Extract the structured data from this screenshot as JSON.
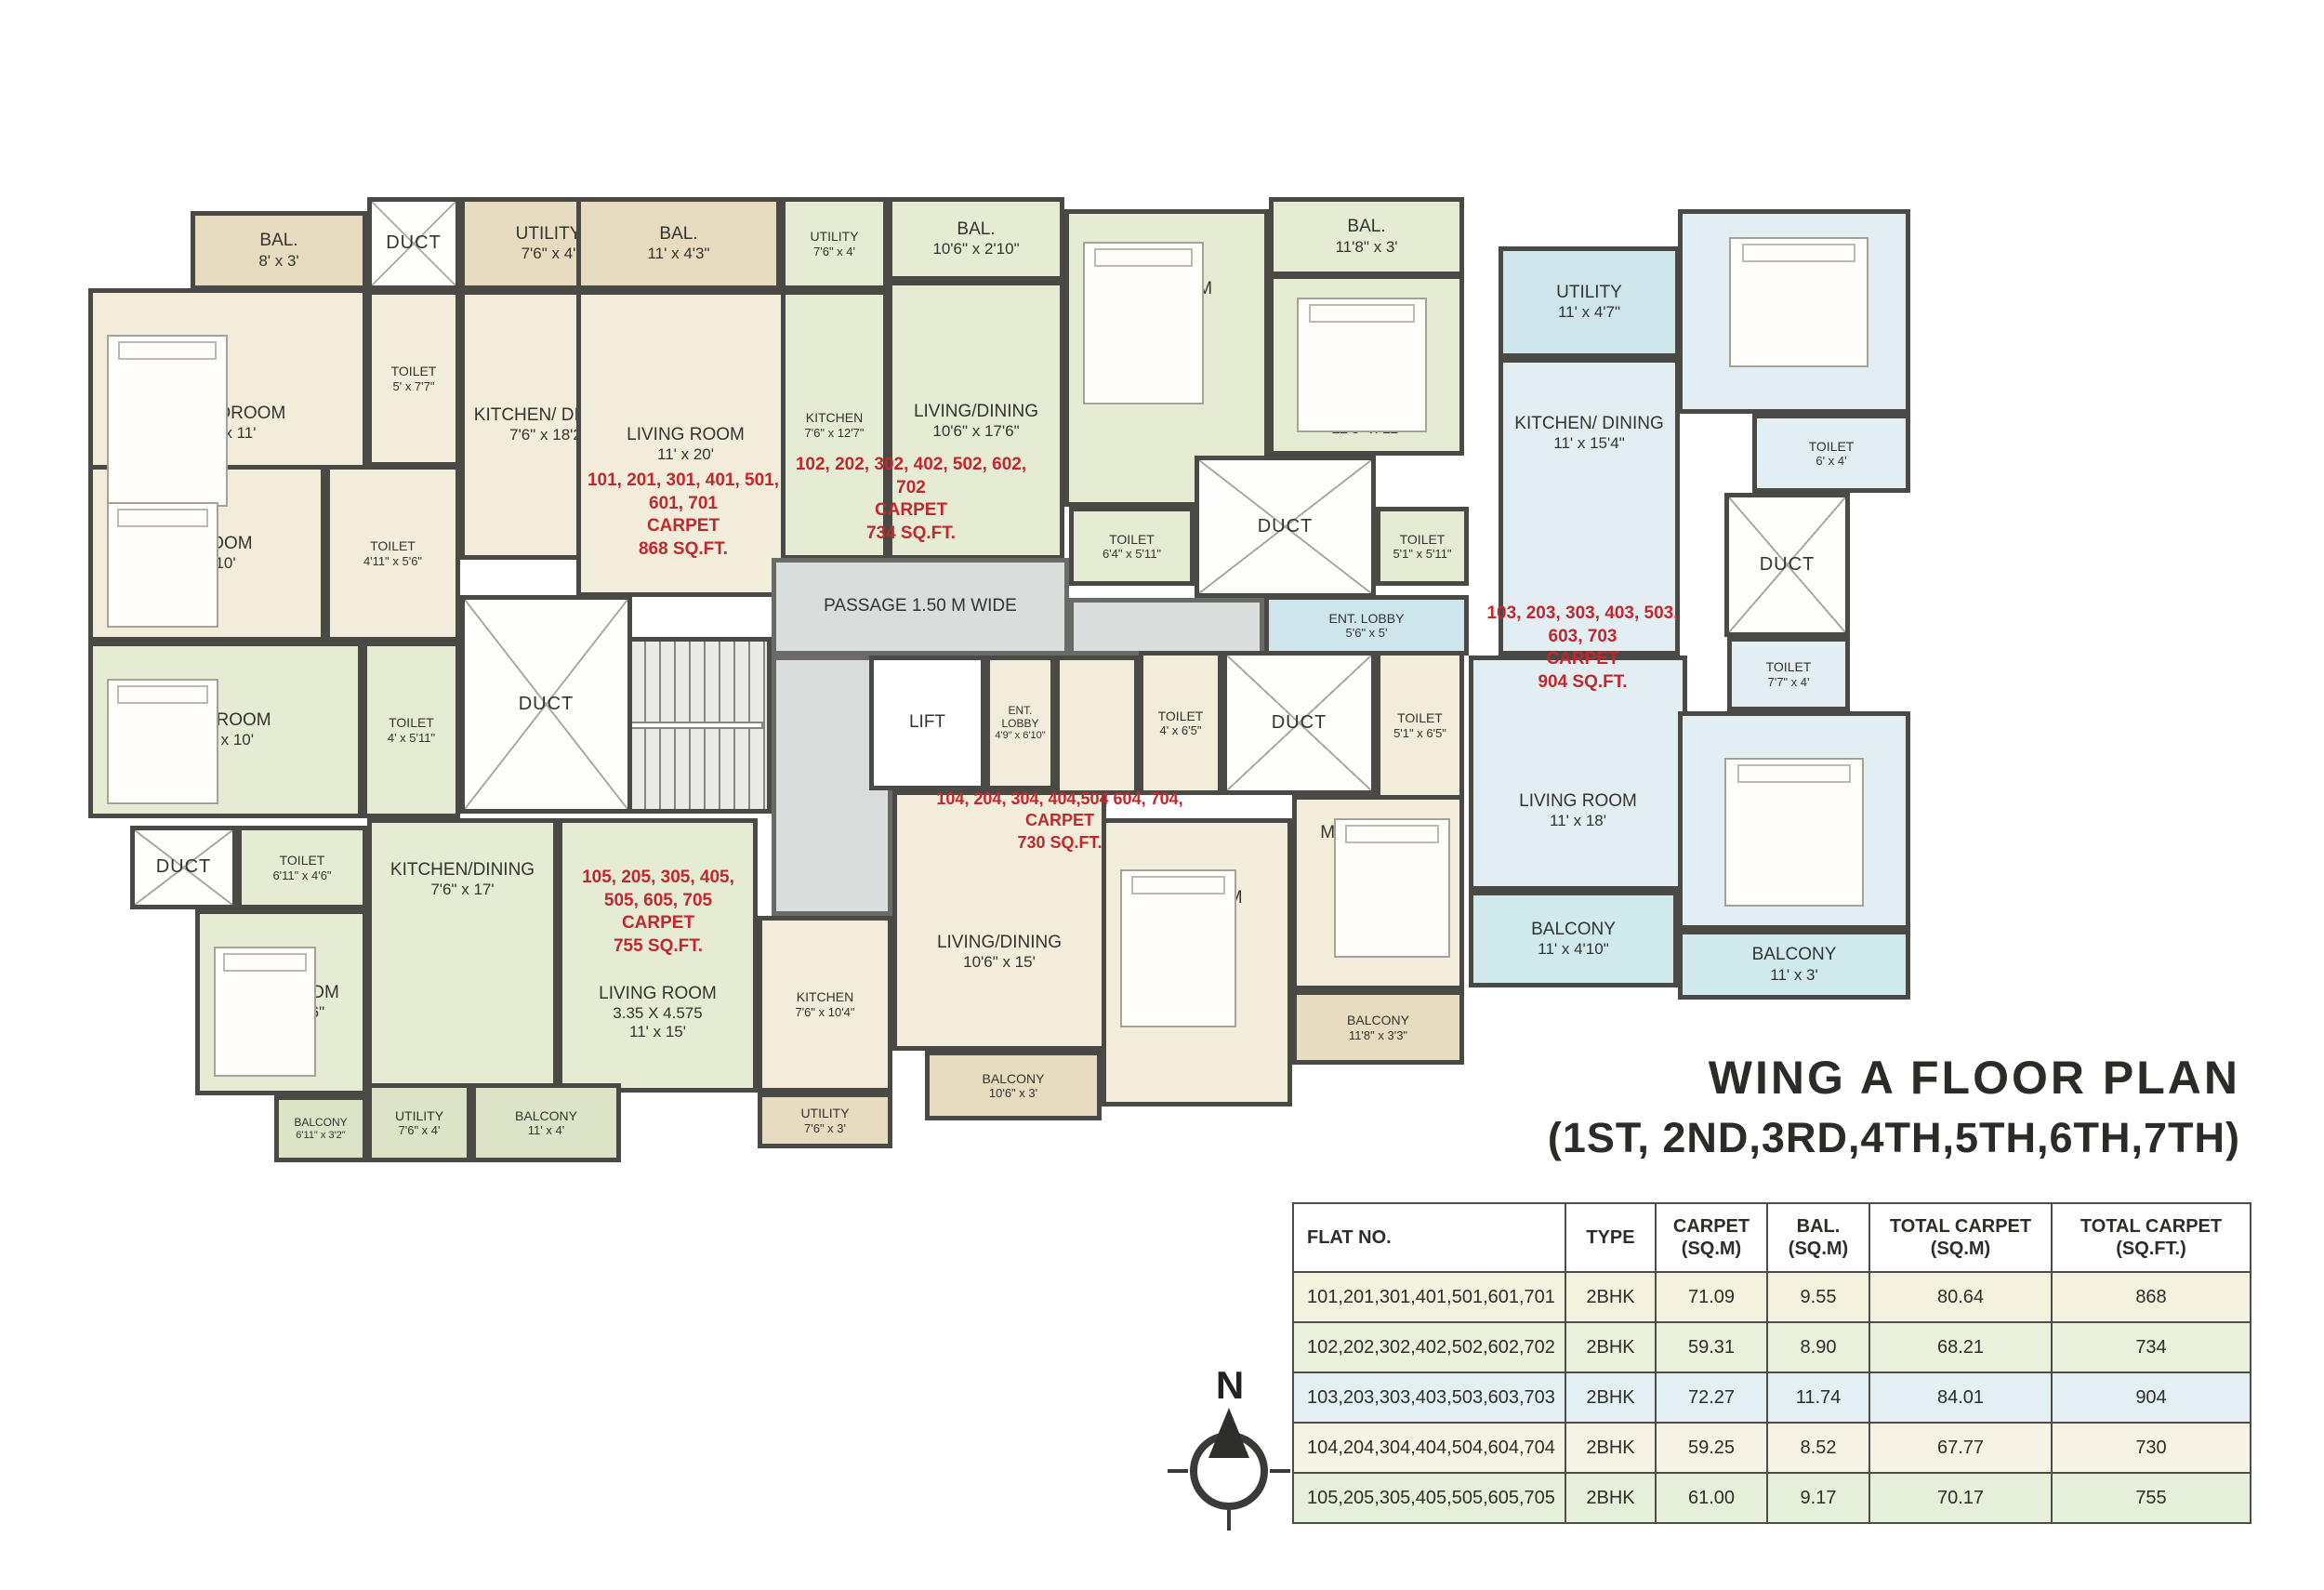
{
  "title": {
    "main": "WING A FLOOR PLAN",
    "sub": "(1ST, 2ND,3RD,4TH,5TH,6TH,7TH)"
  },
  "compass": {
    "north_label": "N"
  },
  "stairs": {
    "dn": "DN",
    "up": "UP"
  },
  "colors": {
    "flat101_cream": "#f2ecda",
    "balcony_tan": "#e7dbc0",
    "flat102_105_green": "#e6ecd4",
    "flat103_blue": "#e2eef2",
    "flat103_utility_blue": "#cfe5ec",
    "flat103_balcony_cyan": "#cfe9ed",
    "passage_grey": "#d9dedd",
    "red_note": "#c1282e",
    "wall": "#4b4946"
  },
  "rooms": [
    {
      "name": "BAL.",
      "dims": "8' x 3'"
    },
    {
      "name": "DUCT",
      "dims": ""
    },
    {
      "name": "UTILITY",
      "dims": "7'6\" x 4'"
    },
    {
      "name": "BAL.",
      "dims": "11' x 4'3\""
    },
    {
      "name": "UTILITY",
      "dims": "7'6\" x 4'"
    },
    {
      "name": "BAL.",
      "dims": "10'6\" x 2'10\""
    },
    {
      "name": "BAL.",
      "dims": "11'8\" x 3'"
    },
    {
      "name": "UTILITY",
      "dims": "11' x 4'7\""
    },
    {
      "name": "M. BEDROOM",
      "dims": "13' x 11'"
    },
    {
      "name": "TOILET",
      "dims": "5' x 7'7\""
    },
    {
      "name": "KITCHEN/ DINING",
      "dims": "7'6\" x 18'2\""
    },
    {
      "name": "LIVING ROOM",
      "dims": "11' x 20'"
    },
    {
      "name": "KITCHEN",
      "dims": "7'6\" x 12'7\""
    },
    {
      "name": "LIVING/DINING",
      "dims": "10'6\" x 17'6\""
    },
    {
      "name": "BEDROOM",
      "dims": "10' x 10'1\""
    },
    {
      "name": "M. BEDROOM",
      "dims": "11'8\" x 11'"
    },
    {
      "name": "TOILET",
      "dims": "6'4\" x 5'11\""
    },
    {
      "name": "DUCT",
      "dims": ""
    },
    {
      "name": "TOILET",
      "dims": "5'1\" x 5'11\""
    },
    {
      "name": "BEDROOM",
      "dims": "11'x 10'6\""
    },
    {
      "name": "KITCHEN/ DINING",
      "dims": "11' x 15'4\""
    },
    {
      "name": "TOILET",
      "dims": "6' x 4'"
    },
    {
      "name": "DUCT",
      "dims": ""
    },
    {
      "name": "TOILET",
      "dims": "7'7\" x 4'"
    },
    {
      "name": "PASSAGE 1.50 M WIDE",
      "dims": ""
    },
    {
      "name": "ENT. LOBBY",
      "dims": "5'6\" x 5'"
    },
    {
      "name": "LIFT",
      "dims": ""
    },
    {
      "name": "ENT. LOBBY",
      "dims": "4'9\" x 6'10\""
    },
    {
      "name": "TOILET",
      "dims": "4' x 6'5\""
    },
    {
      "name": "DUCT",
      "dims": ""
    },
    {
      "name": "TOILET",
      "dims": "5'1\" x 6'5\""
    },
    {
      "name": "M. BEDROOM",
      "dims": "11'8\" x 11'"
    },
    {
      "name": "BALCONY",
      "dims": "11'8\" x 3'3\""
    },
    {
      "name": "BEDROOM",
      "dims": "10' x 11'6\""
    },
    {
      "name": "LIVING/DINING",
      "dims": "10'6\" x 15'"
    },
    {
      "name": "BALCONY",
      "dims": "10'6\" x 3'"
    },
    {
      "name": "KITCHEN",
      "dims": "7'6\" x 10'4\""
    },
    {
      "name": "UTILITY",
      "dims": "7'6\" x 3'"
    },
    {
      "name": "BEDROOM",
      "dims": "12' x 10'"
    },
    {
      "name": "TOILET",
      "dims": "4'11\" x 5'6\""
    },
    {
      "name": "BEDROOM",
      "dims": "11' x 10'"
    },
    {
      "name": "TOILET",
      "dims": "4' x 5'11\""
    },
    {
      "name": "DUCT",
      "dims": ""
    },
    {
      "name": "KITCHEN/DINING",
      "dims": "7'6\" x 17'"
    },
    {
      "name": "DUCT",
      "dims": ""
    },
    {
      "name": "TOILET",
      "dims": "6'11\" x 4'6\""
    },
    {
      "name": "M. BEDROOM",
      "dims": "12'6\" x 10'6\""
    },
    {
      "name": "LIVING ROOM",
      "dims": "3.35 X 4.575",
      "dims2": "11' x 15'"
    },
    {
      "name": "BALCONY",
      "dims": "6'11\" x 3'2\""
    },
    {
      "name": "UTILITY",
      "dims": "7'6\" x 4'"
    },
    {
      "name": "BALCONY",
      "dims": "11' x 4'"
    },
    {
      "name": "LIVING ROOM",
      "dims": "11' x 18'"
    },
    {
      "name": "BALCONY",
      "dims": "11' x 4'10\""
    },
    {
      "name": "M. BEDROOM",
      "dims": "11' x 12'"
    },
    {
      "name": "BALCONY",
      "dims": "11' x 3'"
    }
  ],
  "notes": [
    {
      "flats": "101, 201, 301, 401, 501, 601, 701",
      "carpet": "CARPET",
      "area": "868 SQ.FT."
    },
    {
      "flats": "102, 202, 302, 402, 502, 602, 702",
      "carpet": "CARPET",
      "area": "734 SQ.FT."
    },
    {
      "flats": "103, 203, 303, 403, 503, 603, 703",
      "carpet": "CARPET",
      "area": "904 SQ.FT."
    },
    {
      "flats": "104, 204, 304, 404,504 604, 704,",
      "carpet": "CARPET",
      "area": "730 SQ.FT."
    },
    {
      "flats": "105, 205, 305, 405, 505, 605, 705",
      "carpet": "CARPET",
      "area": "755 SQ.FT."
    }
  ],
  "table": {
    "headers": [
      {
        "l1": "FLAT NO.",
        "l2": ""
      },
      {
        "l1": "TYPE",
        "l2": ""
      },
      {
        "l1": "CARPET",
        "l2": "(SQ.M)"
      },
      {
        "l1": "BAL.",
        "l2": "(SQ.M)"
      },
      {
        "l1": "TOTAL CARPET",
        "l2": "(SQ.M)"
      },
      {
        "l1": "TOTAL CARPET",
        "l2": "(SQ.FT.)"
      }
    ],
    "rows": [
      [
        "101,201,301,401,501,601,701",
        "2BHK",
        "71.09",
        "9.55",
        "80.64",
        "868"
      ],
      [
        "102,202,302,402,502,602,702",
        "2BHK",
        "59.31",
        "8.90",
        "68.21",
        "734"
      ],
      [
        "103,203,303,403,503,603,703",
        "2BHK",
        "72.27",
        "11.74",
        "84.01",
        "904"
      ],
      [
        "104,204,304,404,504,604,704",
        "2BHK",
        "59.25",
        "8.52",
        "67.77",
        "730"
      ],
      [
        "105,205,305,405,505,605,705",
        "2BHK",
        "61.00",
        "9.17",
        "70.17",
        "755"
      ]
    ]
  }
}
